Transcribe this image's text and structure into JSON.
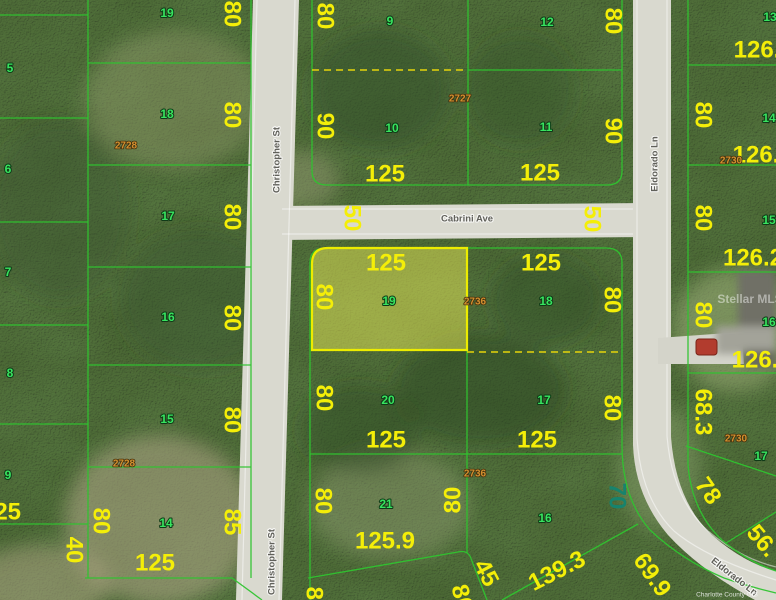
{
  "map": {
    "description": "Aerial parcel map with highlighted vacant lot",
    "highlighted_lot": {
      "lot_number": "19",
      "block_number": "2736",
      "frontage": "125",
      "depth": "80"
    },
    "colors": {
      "parcel_line": "#2fc42f",
      "highlight_stroke": "#ecec00",
      "highlight_fill": "rgba(233,233,85,0.5)",
      "dimension_text": "#f4ee08",
      "lot_text": "#38e45f",
      "block_text": "#d3902f"
    },
    "labels": {
      "dimensions": [
        {
          "t": "80",
          "x": 232,
          "y": 14,
          "r": 90
        },
        {
          "t": "80",
          "x": 232,
          "y": 115,
          "r": 90
        },
        {
          "t": "80",
          "x": 232,
          "y": 217,
          "r": 90
        },
        {
          "t": "80",
          "x": 232,
          "y": 318,
          "r": 90
        },
        {
          "t": "80",
          "x": 232,
          "y": 420,
          "r": 90
        },
        {
          "t": "85",
          "x": 232,
          "y": 522,
          "r": 90
        },
        {
          "t": "80",
          "x": 101,
          "y": 521,
          "r": 90
        },
        {
          "t": "40",
          "x": 74,
          "y": 550,
          "r": 90
        },
        {
          "t": "125",
          "x": 155,
          "y": 563,
          "r": 0
        },
        {
          "t": "125",
          "x": 1,
          "y": 512,
          "r": 0
        },
        {
          "t": "80",
          "x": 325,
          "y": 16,
          "r": 90
        },
        {
          "t": "90",
          "x": 325,
          "y": 126,
          "r": 90
        },
        {
          "t": "80",
          "x": 613,
          "y": 21,
          "r": 90
        },
        {
          "t": "90",
          "x": 613,
          "y": 131,
          "r": 90
        },
        {
          "t": "125",
          "x": 385,
          "y": 174,
          "r": 0
        },
        {
          "t": "125",
          "x": 540,
          "y": 173,
          "r": 0
        },
        {
          "t": "50",
          "x": 352,
          "y": 218,
          "r": 90
        },
        {
          "t": "50",
          "x": 592,
          "y": 219,
          "r": 90
        },
        {
          "t": "125",
          "x": 386,
          "y": 263,
          "r": 0
        },
        {
          "t": "125",
          "x": 541,
          "y": 263,
          "r": 0
        },
        {
          "t": "80",
          "x": 324,
          "y": 297,
          "r": 90
        },
        {
          "t": "80",
          "x": 612,
          "y": 300,
          "r": 90
        },
        {
          "t": "80",
          "x": 324,
          "y": 398,
          "r": 90
        },
        {
          "t": "80",
          "x": 612,
          "y": 408,
          "r": 90
        },
        {
          "t": "125",
          "x": 386,
          "y": 440,
          "r": 0
        },
        {
          "t": "125",
          "x": 537,
          "y": 440,
          "r": 0
        },
        {
          "t": "80",
          "x": 323,
          "y": 501,
          "r": 90
        },
        {
          "t": "80",
          "x": 453,
          "y": 500,
          "r": -90
        },
        {
          "t": "125.9",
          "x": 385,
          "y": 541,
          "r": 0
        },
        {
          "t": "80",
          "x": 703,
          "y": 115,
          "r": 90
        },
        {
          "t": "80",
          "x": 703,
          "y": 218,
          "r": 90
        },
        {
          "t": "80",
          "x": 703,
          "y": 315,
          "r": 90
        },
        {
          "t": "68.3",
          "x": 703,
          "y": 412,
          "r": 90
        },
        {
          "t": "126.",
          "x": 757,
          "y": 50,
          "r": 0
        },
        {
          "t": "126.",
          "x": 756,
          "y": 155,
          "r": 0
        },
        {
          "t": "126.2",
          "x": 753,
          "y": 258,
          "r": 0
        },
        {
          "t": "126.",
          "x": 755,
          "y": 360,
          "r": 0
        },
        {
          "t": "139.3",
          "x": 557,
          "y": 571,
          "r": -27
        },
        {
          "t": "45",
          "x": 486,
          "y": 573,
          "r": 62
        },
        {
          "t": "69.9",
          "x": 652,
          "y": 575,
          "r": 55
        },
        {
          "t": "78",
          "x": 708,
          "y": 491,
          "r": 55
        },
        {
          "t": "56.",
          "x": 762,
          "y": 541,
          "r": 50
        },
        {
          "t": "70",
          "x": 617,
          "y": 496,
          "r": 90,
          "c": "teal"
        },
        {
          "t": "80",
          "x": 314,
          "y": 600,
          "r": 90
        },
        {
          "t": "80",
          "x": 462,
          "y": 598,
          "r": 75
        }
      ],
      "lots": [
        {
          "t": "19",
          "x": 167,
          "y": 13
        },
        {
          "t": "18",
          "x": 167,
          "y": 114
        },
        {
          "t": "17",
          "x": 168,
          "y": 216
        },
        {
          "t": "16",
          "x": 168,
          "y": 317
        },
        {
          "t": "15",
          "x": 167,
          "y": 419
        },
        {
          "t": "14",
          "x": 166,
          "y": 523
        },
        {
          "t": "5",
          "x": 10,
          "y": 68
        },
        {
          "t": "6",
          "x": 8,
          "y": 169
        },
        {
          "t": "7",
          "x": 8,
          "y": 272
        },
        {
          "t": "8",
          "x": 10,
          "y": 373
        },
        {
          "t": "9",
          "x": 8,
          "y": 475
        },
        {
          "t": "9",
          "x": 390,
          "y": 21
        },
        {
          "t": "10",
          "x": 392,
          "y": 128
        },
        {
          "t": "12",
          "x": 547,
          "y": 22
        },
        {
          "t": "11",
          "x": 546,
          "y": 127
        },
        {
          "t": "13",
          "x": 770,
          "y": 17
        },
        {
          "t": "14",
          "x": 769,
          "y": 118
        },
        {
          "t": "15",
          "x": 769,
          "y": 220
        },
        {
          "t": "16",
          "x": 769,
          "y": 322
        },
        {
          "t": "17",
          "x": 761,
          "y": 456
        },
        {
          "t": "19",
          "x": 389,
          "y": 301
        },
        {
          "t": "18",
          "x": 546,
          "y": 301
        },
        {
          "t": "20",
          "x": 388,
          "y": 400
        },
        {
          "t": "17",
          "x": 544,
          "y": 400
        },
        {
          "t": "21",
          "x": 386,
          "y": 504
        },
        {
          "t": "16",
          "x": 545,
          "y": 518
        }
      ],
      "blocks": [
        {
          "t": "2728",
          "x": 126,
          "y": 146
        },
        {
          "t": "2728",
          "x": 124,
          "y": 464
        },
        {
          "t": "2727",
          "x": 460,
          "y": 99
        },
        {
          "t": "2736",
          "x": 475,
          "y": 302
        },
        {
          "t": "2736",
          "x": 475,
          "y": 474
        },
        {
          "t": "2730",
          "x": 731,
          "y": 161
        },
        {
          "t": "2730",
          "x": 736,
          "y": 439
        }
      ],
      "streets": [
        {
          "t": "Christopher St",
          "x": 277,
          "y": 160,
          "r": -90
        },
        {
          "t": "Christopher St",
          "x": 272,
          "y": 562,
          "r": -90
        },
        {
          "t": "Cabrini Ave",
          "x": 467,
          "y": 219,
          "r": 0
        },
        {
          "t": "Eldorado Ln",
          "x": 655,
          "y": 164,
          "r": -90
        },
        {
          "t": "Eldorado Ln",
          "x": 734,
          "y": 577,
          "r": 38
        }
      ],
      "watermarks": [
        {
          "t": "Stellar MLS",
          "x": 750,
          "y": 299,
          "r": 0
        },
        {
          "t": "Charlotte County GIS",
          "x": 727,
          "y": 595,
          "r": 0,
          "c": "wm-small"
        }
      ]
    }
  }
}
